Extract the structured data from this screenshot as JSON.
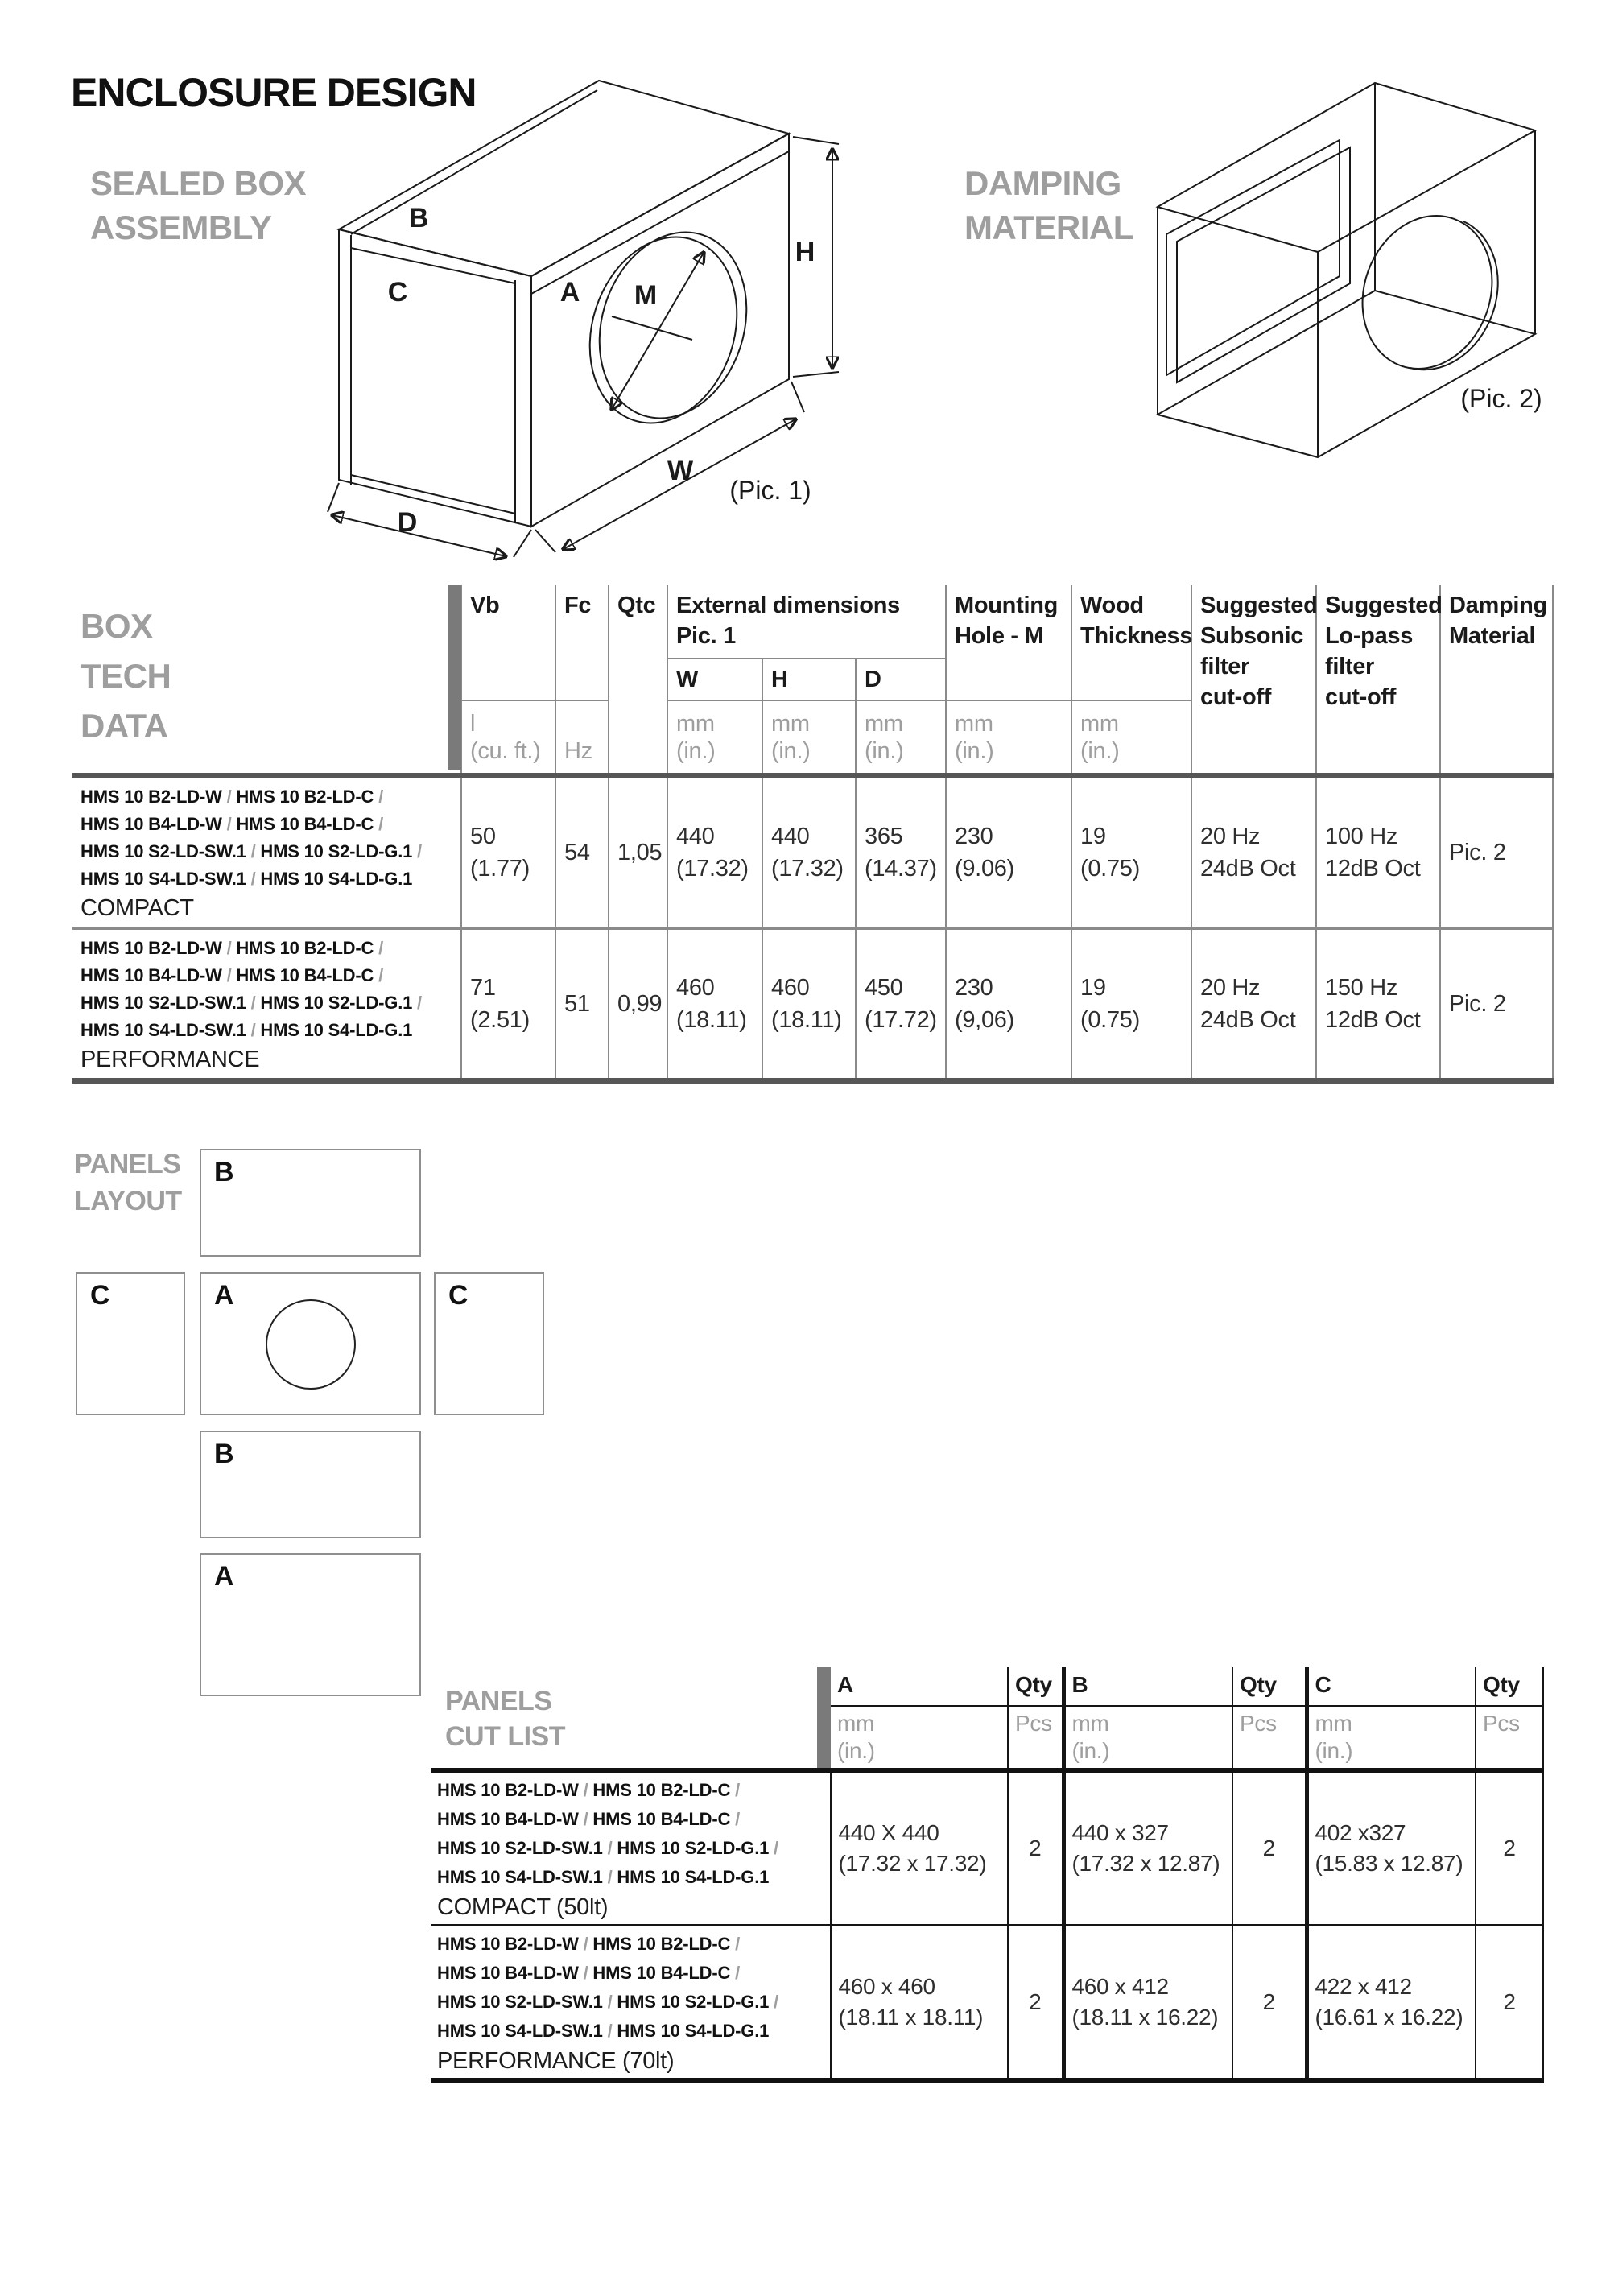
{
  "colors": {
    "heading_gray": "#9e9e9e",
    "accent_bar_gray": "#7a7a7a",
    "thin_line_gray": "#8a8a8a",
    "thick_line_gray": "#565656",
    "table_black": "#151515",
    "damping_panel_fill": "#bfbfbf",
    "damping_panel_edge": "#d9d9d9"
  },
  "title": "ENCLOSURE DESIGN",
  "model_separator": "/",
  "sealed_box": {
    "heading": "SEALED BOX\nASSEMBLY",
    "caption": "(Pic. 1)",
    "labels": {
      "top_panel": "B",
      "side_panel": "C",
      "front_panel": "A",
      "hole": "M",
      "height": "H",
      "width": "W",
      "depth": "D"
    }
  },
  "damping": {
    "heading": "DAMPING\nMATERIAL",
    "caption": "(Pic. 2)"
  },
  "tech_table": {
    "heading": "BOX\nTECH\nDATA",
    "header": {
      "vb": "Vb",
      "vb_unit": "l\n(cu. ft.)",
      "fc": "Fc",
      "fc_unit": "Hz",
      "qtc": "Qtc",
      "external": "External dimensions\nPic. 1",
      "w": "W",
      "h": "H",
      "d": "D",
      "unit_mm": "mm\n(in.)",
      "mounting": "Mounting\nHole - M",
      "wood": "Wood\nThickness",
      "subsonic": "Suggested\nSubsonic\nfilter\ncut-off",
      "lopass": "Suggested\nLo-pass\nfilter\ncut-off",
      "damping": "Damping\nMaterial"
    },
    "rows": [
      {
        "models": [
          "HMS 10 B2-LD-W",
          "HMS 10 B2-LD-C",
          "HMS 10 B4-LD-W",
          "HMS 10 B4-LD-C",
          "HMS 10 S2-LD-SW.1",
          "HMS 10 S2-LD-G.1",
          "HMS 10 S4-LD-SW.1",
          "HMS 10 S4-LD-G.1"
        ],
        "variant": "COMPACT",
        "vb": "50\n(1.77)",
        "fc": "54",
        "qtc": "1,05",
        "w": "440\n(17.32)",
        "h": "440\n(17.32)",
        "d": "365\n(14.37)",
        "m": "230\n(9.06)",
        "wood": "19\n(0.75)",
        "subsonic": "20 Hz\n24dB Oct",
        "lopass": "100 Hz\n12dB Oct",
        "damping": "Pic. 2"
      },
      {
        "models": [
          "HMS 10 B2-LD-W",
          "HMS 10 B2-LD-C",
          "HMS 10 B4-LD-W",
          "HMS 10 B4-LD-C",
          "HMS 10 S2-LD-SW.1",
          "HMS 10 S2-LD-G.1",
          "HMS 10 S4-LD-SW.1",
          "HMS 10 S4-LD-G.1"
        ],
        "variant": "PERFORMANCE",
        "vb": "71\n(2.51)",
        "fc": "51",
        "qtc": "0,99",
        "w": "460\n(18.11)",
        "h": "460\n(18.11)",
        "d": "450\n(17.72)",
        "m": "230\n(9,06)",
        "wood": "19\n(0.75)",
        "subsonic": "20 Hz\n24dB Oct",
        "lopass": "150 Hz\n12dB Oct",
        "damping": "Pic. 2"
      }
    ]
  },
  "panels_layout": {
    "heading": "PANELS\nLAYOUT",
    "b_top": "B",
    "c_left": "C",
    "a_middle": "A",
    "c_right": "C",
    "b_bottom": "B",
    "a_bottom": "A"
  },
  "cut_list": {
    "heading": "PANELS\nCUT LIST",
    "header": {
      "a": "A",
      "b": "B",
      "c": "C",
      "qty": "Qty",
      "unit_mm": "mm\n(in.)",
      "unit_pcs": "Pcs"
    },
    "rows": [
      {
        "models": [
          "HMS 10 B2-LD-W",
          "HMS 10 B2-LD-C",
          "HMS 10 B4-LD-W",
          "HMS 10 B4-LD-C",
          "HMS 10 S2-LD-SW.1",
          "HMS 10 S2-LD-G.1",
          "HMS 10 S4-LD-SW.1",
          "HMS 10 S4-LD-G.1"
        ],
        "variant": "COMPACT (50lt)",
        "a": "440 X 440\n(17.32 x 17.32)",
        "a_qty": "2",
        "b": "440 x 327\n(17.32 x 12.87)",
        "b_qty": "2",
        "c": "402 x327\n(15.83 x 12.87)",
        "c_qty": "2"
      },
      {
        "models": [
          "HMS 10 B2-LD-W",
          "HMS 10 B2-LD-C",
          "HMS 10 B4-LD-W",
          "HMS 10 B4-LD-C",
          "HMS 10 S2-LD-SW.1",
          "HMS 10 S2-LD-G.1",
          "HMS 10 S4-LD-SW.1",
          "HMS 10 S4-LD-G.1"
        ],
        "variant": "PERFORMANCE (70lt)",
        "a": "460 x 460\n(18.11 x 18.11)",
        "a_qty": "2",
        "b": "460 x 412\n(18.11 x 16.22)",
        "b_qty": "2",
        "c": "422 x 412\n(16.61 x 16.22)",
        "c_qty": "2"
      }
    ]
  }
}
